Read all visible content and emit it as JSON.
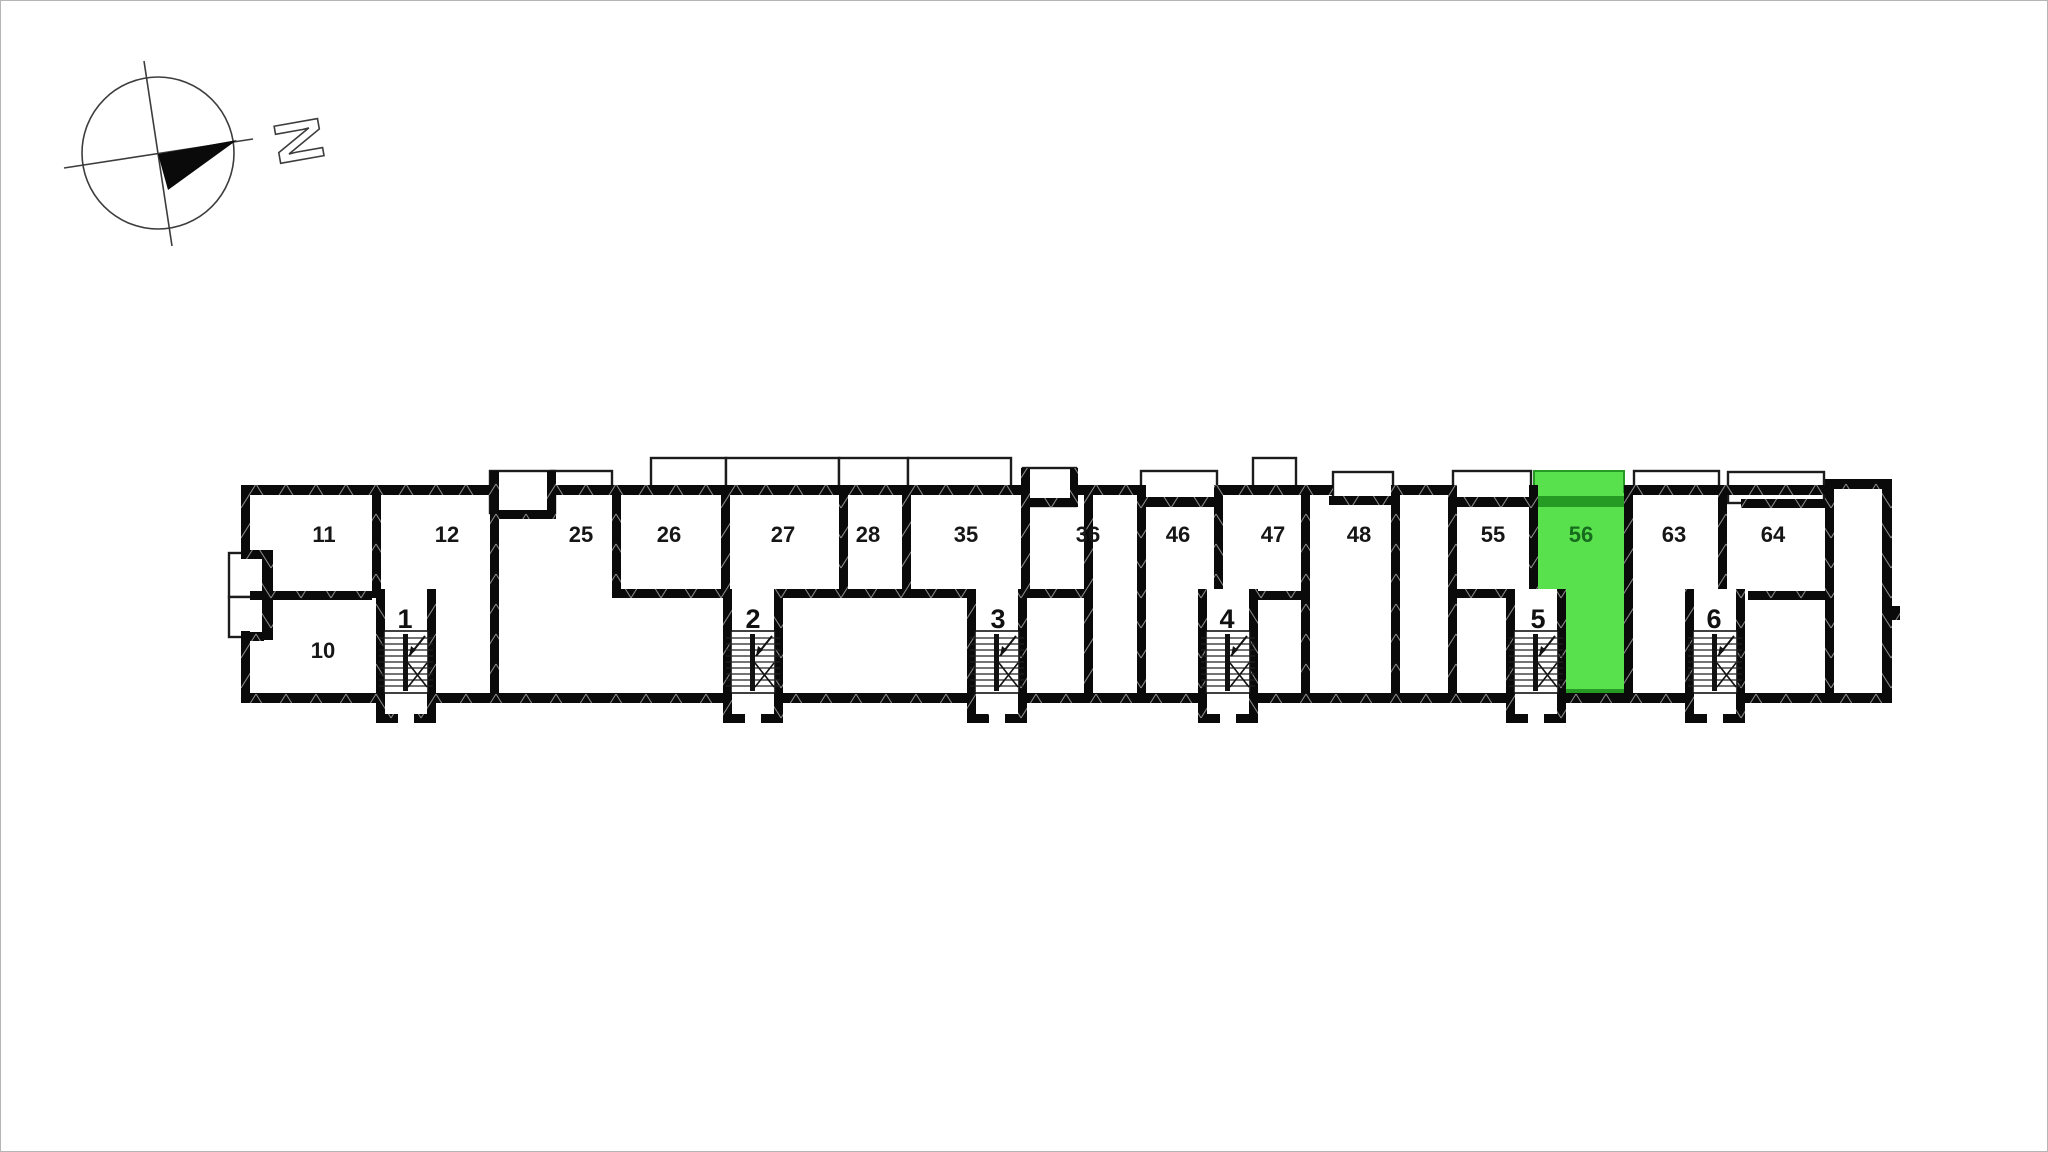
{
  "plan": {
    "compass": {
      "north_label": "N"
    },
    "units": [
      {
        "number": "10",
        "highlighted": false
      },
      {
        "number": "11",
        "highlighted": false
      },
      {
        "number": "12",
        "highlighted": false
      },
      {
        "number": "25",
        "highlighted": false
      },
      {
        "number": "26",
        "highlighted": false
      },
      {
        "number": "27",
        "highlighted": false
      },
      {
        "number": "28",
        "highlighted": false
      },
      {
        "number": "35",
        "highlighted": false
      },
      {
        "number": "36",
        "highlighted": false
      },
      {
        "number": "46",
        "highlighted": false
      },
      {
        "number": "47",
        "highlighted": false
      },
      {
        "number": "48",
        "highlighted": false
      },
      {
        "number": "55",
        "highlighted": false
      },
      {
        "number": "56",
        "highlighted": true
      },
      {
        "number": "63",
        "highlighted": false
      },
      {
        "number": "64",
        "highlighted": false
      }
    ],
    "stairwells": [
      {
        "number": "1"
      },
      {
        "number": "2"
      },
      {
        "number": "3"
      },
      {
        "number": "4"
      },
      {
        "number": "5"
      },
      {
        "number": "6"
      }
    ],
    "colors": {
      "highlight": "#58e14c",
      "highlight_dark": "#259b23",
      "highlight_text": "#176b1d",
      "wall": "#0a0a0a"
    }
  }
}
